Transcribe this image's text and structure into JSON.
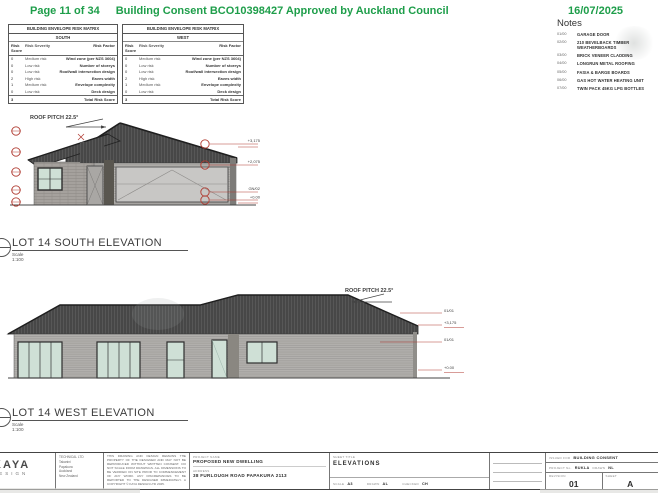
{
  "colors": {
    "accent_green": "#1e9e4a",
    "annotation_red": "#b03a30",
    "roof": "#474747",
    "wall": "#b2b0ad",
    "glass": "#cfe0d6"
  },
  "header": {
    "page_label": "Page 11 of 34",
    "title": "Building Consent BCO10398427 Approved by Auckland Council",
    "date": "16/07/2025"
  },
  "risk_matrix": {
    "title": "BUILDING ENVELOPE RISK MATRIX",
    "columns": [
      "Risk Score",
      "Risk Severity",
      "Risk Factor"
    ],
    "tables": [
      {
        "orientation": "SOUTH",
        "rows": [
          {
            "score": "0",
            "severity": "Medium risk",
            "factor": "Wind zone (per NZS 3604)"
          },
          {
            "score": "0",
            "severity": "Low risk",
            "factor": "Number of storeys"
          },
          {
            "score": "0",
            "severity": "Low risk",
            "factor": "Roof/wall intersection design"
          },
          {
            "score": "2",
            "severity": "High risk",
            "factor": "Eaves width"
          },
          {
            "score": "1",
            "severity": "Medium risk",
            "factor": "Envelope complexity"
          },
          {
            "score": "0",
            "severity": "Low risk",
            "factor": "Deck design"
          }
        ],
        "total_score": "3",
        "total_label": "Total Risk Score"
      },
      {
        "orientation": "WEST",
        "rows": [
          {
            "score": "0",
            "severity": "Medium risk",
            "factor": "Wind zone (per NZS 3604)"
          },
          {
            "score": "0",
            "severity": "Low risk",
            "factor": "Number of storeys"
          },
          {
            "score": "0",
            "severity": "Low risk",
            "factor": "Roof/wall intersection design"
          },
          {
            "score": "2",
            "severity": "High risk",
            "factor": "Eaves width"
          },
          {
            "score": "1",
            "severity": "Medium risk",
            "factor": "Envelope complexity"
          },
          {
            "score": "0",
            "severity": "Low risk",
            "factor": "Deck design"
          }
        ],
        "total_score": "3",
        "total_label": "Total Risk Score"
      }
    ]
  },
  "notes": {
    "heading": "Notes",
    "items": [
      {
        "code": "01/00",
        "label": "GARAGE DOOR"
      },
      {
        "code": "02/00",
        "label": "210 BEVELBACK TIMBER WEATHERBOARDS"
      },
      {
        "code": "03/00",
        "label": "BRICK VENEER CLADDING"
      },
      {
        "code": "04/00",
        "label": "LONGRUN METAL ROOFING"
      },
      {
        "code": "05/00",
        "label": "FASIA & BARGE BOARDS"
      },
      {
        "code": "06/00",
        "label": "GAS HOT WATER HEATING UNIT"
      },
      {
        "code": "07/00",
        "label": "TWIN PACK 45KG LPG BOTTLES"
      }
    ]
  },
  "south_elevation": {
    "roof_pitch": "ROOF PITCH 22.5°",
    "title": "LOT 14 SOUTH ELEVATION",
    "scale": "Scale 1:100",
    "levels": [
      "+3,175",
      "+2,075",
      "GN/02",
      "+0.00"
    ]
  },
  "west_elevation": {
    "roof_pitch": "ROOF PITCH 22.5°",
    "title": "LOT 14 WEST ELEVATION",
    "scale": "Scale 1:100",
    "levels": [
      "01/01",
      "+3,175",
      "01/01",
      "+0.00"
    ]
  },
  "title_block": {
    "logo_line1": "KAYA",
    "logo_line2": "DESIGN",
    "contact_lines": [
      "TECHNICAL LTD",
      "Takanini",
      "Papakura",
      "Auckland",
      "New Zealand"
    ],
    "disclaimer": "THIS DRAWING AND DESIGN REMAINS THE PROPERTY OF THE DESIGNER AND MAY NOT BE REPRODUCED WITHOUT WRITTEN CONSENT. DO NOT SCALE FROM DRAWINGS. ALL DIMENSIONS TO BE VERIFIED ON SITE PRIOR TO COMMENCEMENT OF ANY WORK. ANY DISCREPANCIES TO BE REPORTED TO THE DESIGNER IMMEDIATELY. A COPYRIGHT © KAYA DESIGN LTD 2025.",
    "project_name_label": "PROJECT NAME",
    "project_name": "PROPOSED NEW DWELLING",
    "address_label": "ADDRESS",
    "address": "38 FURLOUGH ROAD PAPAKURA 2113",
    "sheet_title_label": "SHEET TITLE",
    "sheet_title": "ELEVATIONS",
    "scale_label": "SCALE",
    "scale": "A3",
    "drawn_label": "DRAWN",
    "drawn": "AL",
    "checked_label": "CHECKED",
    "checked": "CH",
    "issued_for_label": "ISSUED FOR",
    "issued_for": "BUILDING CONSENT",
    "project_no_label": "PROJECT No.",
    "project_no": "RUKLA",
    "drawn2_label": "DRAWN",
    "drawn2": "NL",
    "revision_label": "REVISION",
    "revision": "01",
    "sheet_label": "SHEET",
    "sheet_no": "A"
  }
}
